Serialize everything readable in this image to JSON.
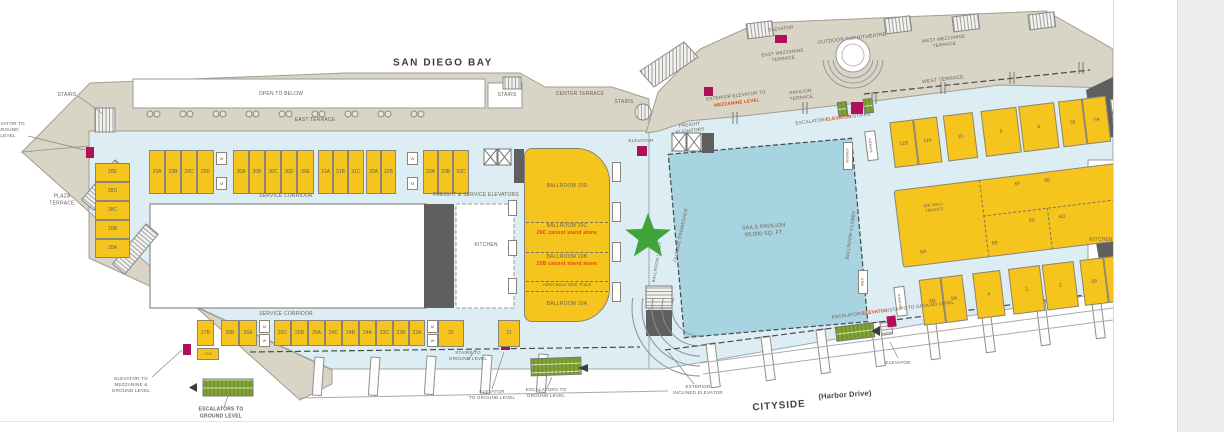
{
  "title": "San Diego Convention Center Upper Level Floor Plan",
  "colors": {
    "floor": "#dcedf3",
    "terrace": "#d8d4c6",
    "room_yellow": "#f6c51d",
    "sails_blue": "#a8d3e0",
    "star_green": "#3fa43a",
    "escalator_green": "#7fa331",
    "elevator_magenta": "#b0105a",
    "warning_red": "#e8430c",
    "ink": "#6b6257",
    "dark_gray": "#5f5f5f"
  },
  "labels": {
    "san_diego_bay": "SAN DIEGO BAY",
    "open_to_below": "OPEN TO BELOW",
    "east_terrace": "EAST TERRACE",
    "stairs": "STAIRS",
    "center_terrace": "CENTER TERRACE",
    "elevator": "ELEVATOR",
    "freight_elevators": [
      "FREIGHT",
      "ELEVATORS"
    ],
    "exterior_elevator_l1": "EXTERIOR ELEVATOR TO",
    "exterior_elevator_l2": "MEZZANINE LEVEL",
    "pavilion_terrace": [
      "PAVILION",
      "TERRACE"
    ],
    "east_mezzanine_terrace": [
      "EAST MEZZANINE",
      "TERRACE"
    ],
    "outdoor_amphitheatre": "OUTDOOR AMPHITHEATRE",
    "west_mezzanine_terrace": [
      "WEST MEZZANINE",
      "TERRACE"
    ],
    "west_terrace": "WEST TERRACE",
    "esc_parts": [
      "ESCALATOR/",
      "ELEVATOR",
      "/STAIRS"
    ],
    "esc_ground_parts": [
      "ESCALATOR/",
      "ELEVATOR",
      "/STAIRS TO GROUND LEVEL"
    ],
    "sails_pavilion": [
      "SAILS PAVILION",
      "90,000 SQ. FT."
    ],
    "outside_promenade": "OUTSIDE PROMENADE",
    "ballroom_lobby": "BALLROOM LOBBY",
    "ballroom6_lobby": "BALLROOM 6 LOBBY",
    "kitchen": "KITCHEN",
    "service_corridor": "SERVICE CORRIDOR",
    "freight_service_elevators": "FREIGHT & SERVICE ELEVATORS",
    "ballroom_20d": "BALLROOM 20D",
    "ballroom_20c": "BALLROOM 20C",
    "note_20c": "20C cannot stand alone",
    "ballroom_20b": "BALLROOM 20B",
    "note_20b": "20B cannot stand alone",
    "alt_wall_track": "Alternative Wall Track",
    "ballroom_20a": "BALLROOM 20A",
    "stairs_to_ground": [
      "STAIRS TO",
      "GROUND LEVEL"
    ],
    "elevator_to_ground": [
      "ELEVATOR",
      "TO GROUND LEVEL"
    ],
    "escalators_to_ground": [
      "ESCALATORS TO",
      "GROUND LEVEL"
    ],
    "exterior_inclined_elevator": [
      "EXTERIOR",
      "INCLINED ELEVATOR"
    ],
    "cityside": "CITYSIDE",
    "harbor_drive": "(Harbor Drive)",
    "elevator_to_mezz_ground": [
      "ELEVATOR TO",
      "MEZZANINE &",
      "GROUND LEVEL"
    ],
    "plaza_terrace": [
      "PLAZA",
      "TERRACE"
    ],
    "elevator_to_ground_left": [
      "ELEVATOR TO",
      "GROUND",
      "LEVEL"
    ],
    "air_wall_tracks": [
      "AIR WALL",
      "TRACKS"
    ]
  },
  "rooms": {
    "left": [
      {
        "t": "28E",
        "x": 95,
        "y": 163,
        "w": 35,
        "h": 19
      },
      {
        "t": "28D",
        "x": 95,
        "y": 182,
        "w": 35,
        "h": 19
      },
      {
        "t": "28C",
        "x": 95,
        "y": 201,
        "w": 35,
        "h": 19
      },
      {
        "t": "28B",
        "x": 95,
        "y": 220,
        "w": 35,
        "h": 19
      },
      {
        "t": "28A",
        "x": 95,
        "y": 239,
        "w": 35,
        "h": 19
      },
      {
        "t": "29A",
        "x": 149,
        "y": 150,
        "w": 16,
        "h": 44
      },
      {
        "t": "29B",
        "x": 165,
        "y": 150,
        "w": 16,
        "h": 44
      },
      {
        "t": "29C",
        "x": 181,
        "y": 150,
        "w": 16,
        "h": 44
      },
      {
        "t": "29D",
        "x": 197,
        "y": 150,
        "w": 17,
        "h": 44
      },
      {
        "t": "W",
        "cls": "wc",
        "x": 216,
        "y": 152,
        "w": 11,
        "h": 13
      },
      {
        "t": "M",
        "cls": "wc",
        "x": 216,
        "y": 177,
        "w": 11,
        "h": 13
      },
      {
        "t": "30A",
        "x": 233,
        "y": 150,
        "w": 16,
        "h": 44
      },
      {
        "t": "30B",
        "x": 249,
        "y": 150,
        "w": 16,
        "h": 44
      },
      {
        "t": "30C",
        "x": 265,
        "y": 150,
        "w": 16,
        "h": 44
      },
      {
        "t": "30D",
        "x": 281,
        "y": 150,
        "w": 16,
        "h": 44
      },
      {
        "t": "30E",
        "x": 297,
        "y": 150,
        "w": 17,
        "h": 44
      },
      {
        "t": "31A",
        "x": 318,
        "y": 150,
        "w": 15,
        "h": 44
      },
      {
        "t": "31B",
        "x": 333,
        "y": 150,
        "w": 15,
        "h": 44
      },
      {
        "t": "31C",
        "x": 348,
        "y": 150,
        "w": 16,
        "h": 44
      },
      {
        "t": "32A",
        "x": 366,
        "y": 150,
        "w": 15,
        "h": 44
      },
      {
        "t": "32B",
        "x": 381,
        "y": 150,
        "w": 15,
        "h": 44
      },
      {
        "t": "W",
        "cls": "wc",
        "x": 407,
        "y": 152,
        "w": 11,
        "h": 13
      },
      {
        "t": "M",
        "cls": "wc",
        "x": 407,
        "y": 177,
        "w": 11,
        "h": 13
      },
      {
        "t": "33A",
        "x": 423,
        "y": 150,
        "w": 15,
        "h": 44
      },
      {
        "t": "33B",
        "x": 438,
        "y": 150,
        "w": 15,
        "h": 44
      },
      {
        "t": "33C",
        "x": 453,
        "y": 150,
        "w": 16,
        "h": 44
      },
      {
        "t": "27B",
        "x": 197,
        "y": 320,
        "w": 17,
        "h": 26
      },
      {
        "t": "27A",
        "x": 197,
        "y": 348,
        "w": 22,
        "h": 12,
        "fs": 4
      },
      {
        "t": "26B",
        "x": 221,
        "y": 320,
        "w": 18,
        "h": 26
      },
      {
        "t": "26A",
        "x": 239,
        "y": 320,
        "w": 18,
        "h": 26
      },
      {
        "t": "M",
        "cls": "wc",
        "x": 259,
        "y": 320,
        "w": 11,
        "h": 13
      },
      {
        "t": "W",
        "cls": "wc",
        "x": 259,
        "y": 334,
        "w": 11,
        "h": 13
      },
      {
        "t": "25C",
        "x": 274,
        "y": 320,
        "w": 17,
        "h": 26
      },
      {
        "t": "25B",
        "x": 291,
        "y": 320,
        "w": 17,
        "h": 26
      },
      {
        "t": "25A",
        "x": 308,
        "y": 320,
        "w": 17,
        "h": 26
      },
      {
        "t": "24C",
        "x": 325,
        "y": 320,
        "w": 17,
        "h": 26
      },
      {
        "t": "24B",
        "x": 342,
        "y": 320,
        "w": 17,
        "h": 26
      },
      {
        "t": "24A",
        "x": 359,
        "y": 320,
        "w": 17,
        "h": 26
      },
      {
        "t": "23C",
        "x": 376,
        "y": 320,
        "w": 17,
        "h": 26
      },
      {
        "t": "23B",
        "x": 393,
        "y": 320,
        "w": 16,
        "h": 26
      },
      {
        "t": "23A",
        "x": 409,
        "y": 320,
        "w": 16,
        "h": 26
      },
      {
        "t": "M",
        "cls": "wc",
        "x": 427,
        "y": 320,
        "w": 11,
        "h": 13
      },
      {
        "t": "W",
        "cls": "wc",
        "x": 427,
        "y": 334,
        "w": 11,
        "h": 13
      },
      {
        "t": "22",
        "x": 438,
        "y": 320,
        "w": 26,
        "h": 27
      },
      {
        "t": "21",
        "x": 498,
        "y": 320,
        "w": 22,
        "h": 27
      },
      {
        "t": "W",
        "cls": "wc",
        "x": 543,
        "y": 152,
        "w": 10,
        "h": 12
      },
      {
        "t": "WOMEN",
        "cls": "wcv",
        "x": 843,
        "y": 142,
        "w": 10,
        "h": 28
      },
      {
        "t": "MEN",
        "cls": "wcv",
        "x": 858,
        "y": 270,
        "w": 10,
        "h": 24
      },
      {
        "cls": "pocket",
        "x": 612,
        "y": 162,
        "w": 9,
        "h": 20
      },
      {
        "cls": "pocket",
        "x": 612,
        "y": 202,
        "w": 9,
        "h": 20
      },
      {
        "cls": "pocket",
        "x": 612,
        "y": 242,
        "w": 9,
        "h": 20
      },
      {
        "cls": "pocket",
        "x": 612,
        "y": 282,
        "w": 9,
        "h": 20
      },
      {
        "cls": "pocket",
        "x": 508,
        "y": 200,
        "w": 9,
        "h": 16
      },
      {
        "cls": "pocket",
        "x": 508,
        "y": 240,
        "w": 9,
        "h": 16
      },
      {
        "cls": "pocket",
        "x": 508,
        "y": 278,
        "w": 9,
        "h": 16
      }
    ],
    "right": [
      {
        "t": "WOMEN",
        "cls": "wcv",
        "x": 2,
        "y": 34,
        "w": 11,
        "h": 30
      },
      {
        "t": "11B",
        "x": 28,
        "y": 28,
        "w": 24,
        "h": 46
      },
      {
        "t": "11A",
        "x": 52,
        "y": 28,
        "w": 24,
        "h": 46
      },
      {
        "t": "10",
        "x": 82,
        "y": 28,
        "w": 30,
        "h": 46
      },
      {
        "t": "9",
        "x": 120,
        "y": 28,
        "w": 36,
        "h": 46
      },
      {
        "t": "8",
        "x": 158,
        "y": 28,
        "w": 36,
        "h": 46
      },
      {
        "t": "7B",
        "x": 198,
        "y": 28,
        "w": 24,
        "h": 46
      },
      {
        "t": "7A",
        "x": 222,
        "y": 28,
        "w": 24,
        "h": 46
      },
      {
        "t": "M",
        "cls": "wc",
        "x": 250,
        "y": 32,
        "w": 11,
        "h": 13
      },
      {
        "t": "W",
        "cls": "wc",
        "x": 250,
        "y": 46,
        "w": 11,
        "h": 13
      },
      {
        "cls": "big",
        "x": 24,
        "y": 96,
        "w": 224,
        "h": 78
      },
      {
        "cls": "dv",
        "x": 110,
        "y": 96,
        "w": 1,
        "h": 78
      },
      {
        "cls": "dv",
        "x": 174,
        "y": 132,
        "w": 1,
        "h": 42
      },
      {
        "cls": "dh",
        "x": 110,
        "y": 132,
        "w": 138,
        "h": 1
      },
      {
        "t": "6F",
        "cls": "lbl2",
        "x": 138,
        "y": 100,
        "w": 20,
        "h": 10
      },
      {
        "t": "6E",
        "cls": "lbl2",
        "x": 168,
        "y": 100,
        "w": 20,
        "h": 10
      },
      {
        "t": "6C",
        "cls": "lbl2",
        "x": 148,
        "y": 138,
        "w": 20,
        "h": 10
      },
      {
        "t": "6D",
        "cls": "lbl2",
        "x": 178,
        "y": 138,
        "w": 20,
        "h": 10
      },
      {
        "t": "6A",
        "cls": "lbl2",
        "x": 36,
        "y": 156,
        "w": 20,
        "h": 10
      },
      {
        "t": "6B",
        "cls": "lbl2",
        "x": 108,
        "y": 156,
        "w": 20,
        "h": 10
      },
      {
        "t": "WOMEN",
        "cls": "wcv",
        "x": 12,
        "y": 192,
        "w": 11,
        "h": 30
      },
      {
        "t": "5B",
        "x": 38,
        "y": 188,
        "w": 22,
        "h": 46
      },
      {
        "t": "5A",
        "x": 60,
        "y": 188,
        "w": 22,
        "h": 46
      },
      {
        "t": "4",
        "x": 92,
        "y": 188,
        "w": 28,
        "h": 46
      },
      {
        "t": "3",
        "x": 128,
        "y": 188,
        "w": 32,
        "h": 46
      },
      {
        "t": "2",
        "x": 162,
        "y": 188,
        "w": 32,
        "h": 46
      },
      {
        "t": "1B",
        "x": 200,
        "y": 188,
        "w": 24,
        "h": 46
      },
      {
        "t": "1A",
        "x": 224,
        "y": 188,
        "w": 24,
        "h": 46
      },
      {
        "t": "W",
        "cls": "wc",
        "x": 252,
        "y": 190,
        "w": 11,
        "h": 13
      },
      {
        "t": "M",
        "cls": "wc",
        "x": 252,
        "y": 204,
        "w": 11,
        "h": 13
      }
    ]
  }
}
